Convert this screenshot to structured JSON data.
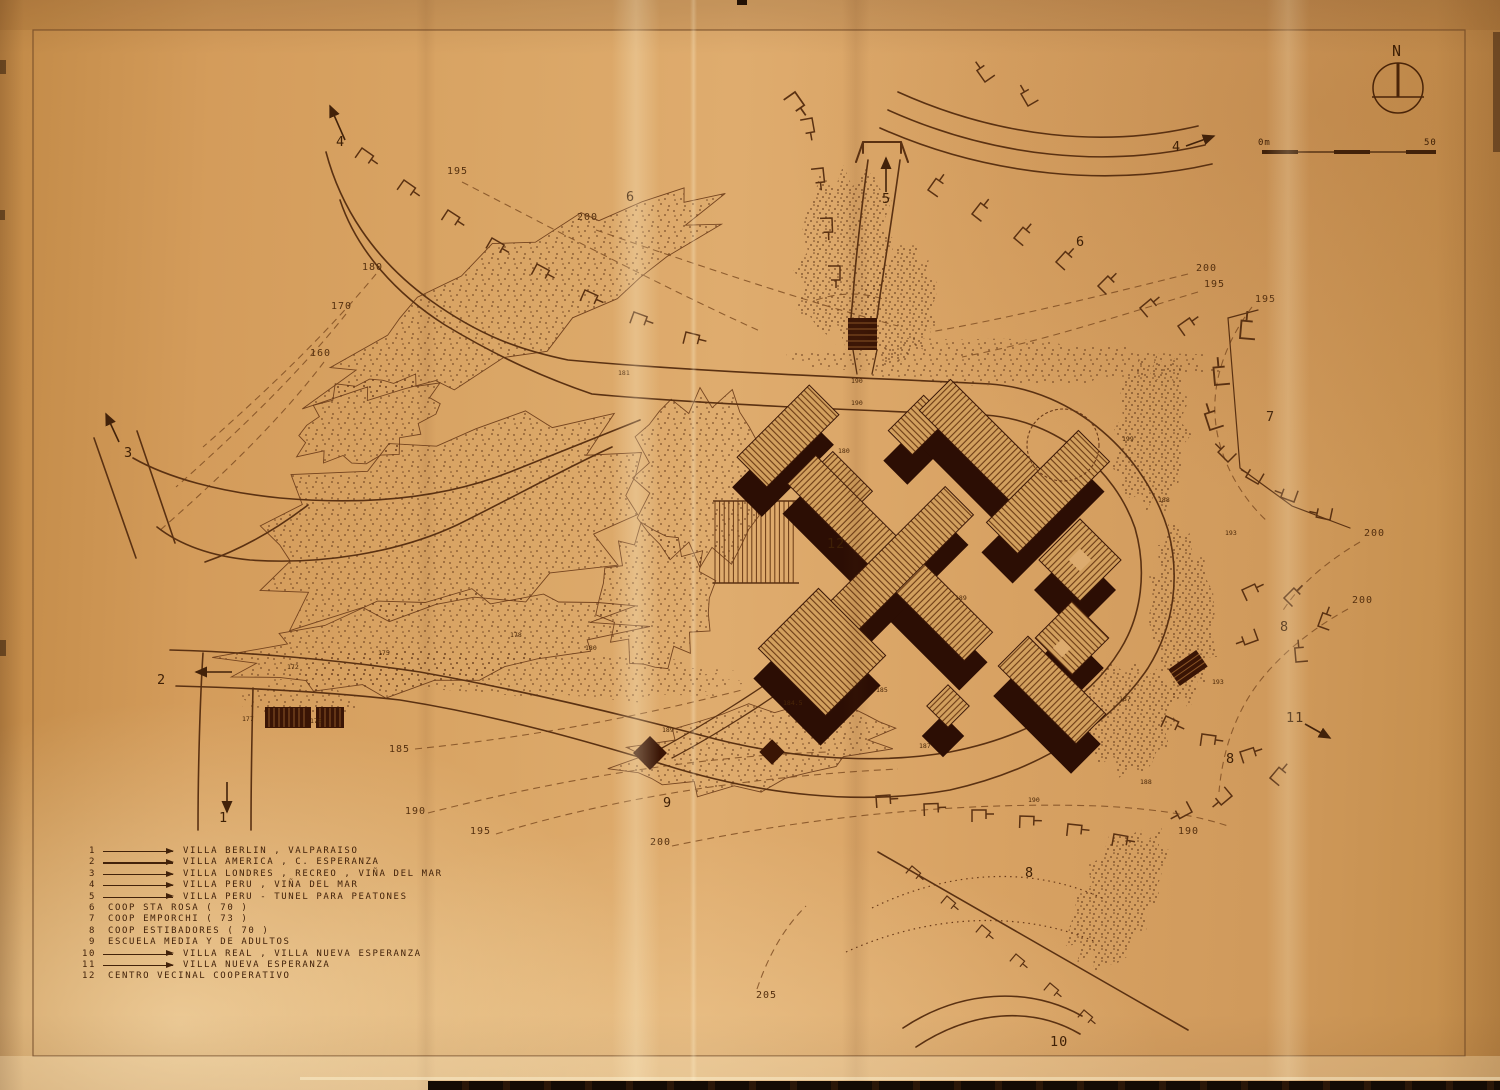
{
  "compass": {
    "label": "N"
  },
  "scalebar": {
    "left": "0m",
    "right": "50"
  },
  "legend": {
    "items": [
      {
        "num": "1",
        "arrow": true,
        "label": "VILLA BERLIN , VALPARAISO"
      },
      {
        "num": "2",
        "arrow": true,
        "label": "VILLA AMERICA , C. ESPERANZA"
      },
      {
        "num": "3",
        "arrow": true,
        "label": "VILLA LONDRES , RECREO , VIÑA DEL MAR"
      },
      {
        "num": "4",
        "arrow": true,
        "label": "VILLA PERU , VIÑA DEL MAR"
      },
      {
        "num": "5",
        "arrow": true,
        "label": "VILLA PERU - TUNEL PARA PEATONES"
      },
      {
        "num": "6",
        "arrow": false,
        "label": "COOP STA ROSA ( 70 )"
      },
      {
        "num": "7",
        "arrow": false,
        "label": "COOP EMPORCHI ( 73 )"
      },
      {
        "num": "8",
        "arrow": false,
        "label": "COOP ESTIBADORES ( 70 )"
      },
      {
        "num": "9",
        "arrow": false,
        "label": "ESCUELA MEDIA Y DE ADULTOS"
      },
      {
        "num": "10",
        "arrow": true,
        "label": "VILLA REAL , VILLA NUEVA ESPERANZA"
      },
      {
        "num": "11",
        "arrow": true,
        "label": "VILLA NUEVA ESPERANZA"
      },
      {
        "num": "12",
        "arrow": false,
        "label": "CENTRO VECINAL COOPERATIVO"
      }
    ]
  },
  "map_labels": {
    "areas": [
      {
        "t": "4",
        "x": 336,
        "y": 146
      },
      {
        "t": "6",
        "x": 626,
        "y": 201
      },
      {
        "t": "5",
        "x": 882,
        "y": 203
      },
      {
        "t": "4",
        "x": 1172,
        "y": 151
      },
      {
        "t": "6",
        "x": 1076,
        "y": 246
      },
      {
        "t": "7",
        "x": 1266,
        "y": 421
      },
      {
        "t": "8",
        "x": 1280,
        "y": 631
      },
      {
        "t": "11",
        "x": 1286,
        "y": 722
      },
      {
        "t": "8",
        "x": 1226,
        "y": 763
      },
      {
        "t": "8",
        "x": 1025,
        "y": 877
      },
      {
        "t": "9",
        "x": 663,
        "y": 807
      },
      {
        "t": "10",
        "x": 1050,
        "y": 1046
      },
      {
        "t": "12",
        "x": 827,
        "y": 548
      },
      {
        "t": "3",
        "x": 124,
        "y": 457
      },
      {
        "t": "2",
        "x": 157,
        "y": 684
      },
      {
        "t": "1",
        "x": 219,
        "y": 822
      }
    ],
    "contours": [
      {
        "t": "195",
        "x": 447,
        "y": 174
      },
      {
        "t": "200",
        "x": 577,
        "y": 220
      },
      {
        "t": "180",
        "x": 362,
        "y": 270
      },
      {
        "t": "170",
        "x": 331,
        "y": 309
      },
      {
        "t": "160",
        "x": 310,
        "y": 356
      },
      {
        "t": "200",
        "x": 1196,
        "y": 271
      },
      {
        "t": "195",
        "x": 1204,
        "y": 287
      },
      {
        "t": "195",
        "x": 1255,
        "y": 302
      },
      {
        "t": "200",
        "x": 1364,
        "y": 536
      },
      {
        "t": "200",
        "x": 1352,
        "y": 603
      },
      {
        "t": "185",
        "x": 389,
        "y": 752
      },
      {
        "t": "190",
        "x": 405,
        "y": 814
      },
      {
        "t": "195",
        "x": 470,
        "y": 834
      },
      {
        "t": "200",
        "x": 650,
        "y": 845
      },
      {
        "t": "190",
        "x": 1178,
        "y": 834
      },
      {
        "t": "205",
        "x": 756,
        "y": 998
      }
    ],
    "spots": [
      {
        "t": "181",
        "x": 618,
        "y": 375
      },
      {
        "t": "190",
        "x": 851,
        "y": 383
      },
      {
        "t": "190",
        "x": 851,
        "y": 405
      },
      {
        "t": "180",
        "x": 838,
        "y": 453
      },
      {
        "t": "199",
        "x": 1122,
        "y": 441
      },
      {
        "t": "188",
        "x": 1158,
        "y": 502
      },
      {
        "t": "193",
        "x": 1225,
        "y": 535
      },
      {
        "t": "193",
        "x": 1212,
        "y": 684
      },
      {
        "t": "187",
        "x": 1119,
        "y": 701
      },
      {
        "t": "189",
        "x": 955,
        "y": 600
      },
      {
        "t": "185",
        "x": 876,
        "y": 692
      },
      {
        "t": "184.5",
        "x": 783,
        "y": 705
      },
      {
        "t": "189",
        "x": 662,
        "y": 732
      },
      {
        "t": "187",
        "x": 919,
        "y": 748
      },
      {
        "t": "190",
        "x": 1028,
        "y": 802
      },
      {
        "t": "188",
        "x": 1140,
        "y": 784
      },
      {
        "t": "172",
        "x": 287,
        "y": 669
      },
      {
        "t": "175",
        "x": 378,
        "y": 655
      },
      {
        "t": "178",
        "x": 510,
        "y": 637
      },
      {
        "t": "180",
        "x": 585,
        "y": 650
      },
      {
        "t": "177",
        "x": 242,
        "y": 721
      },
      {
        "t": "178",
        "x": 310,
        "y": 723
      }
    ]
  }
}
